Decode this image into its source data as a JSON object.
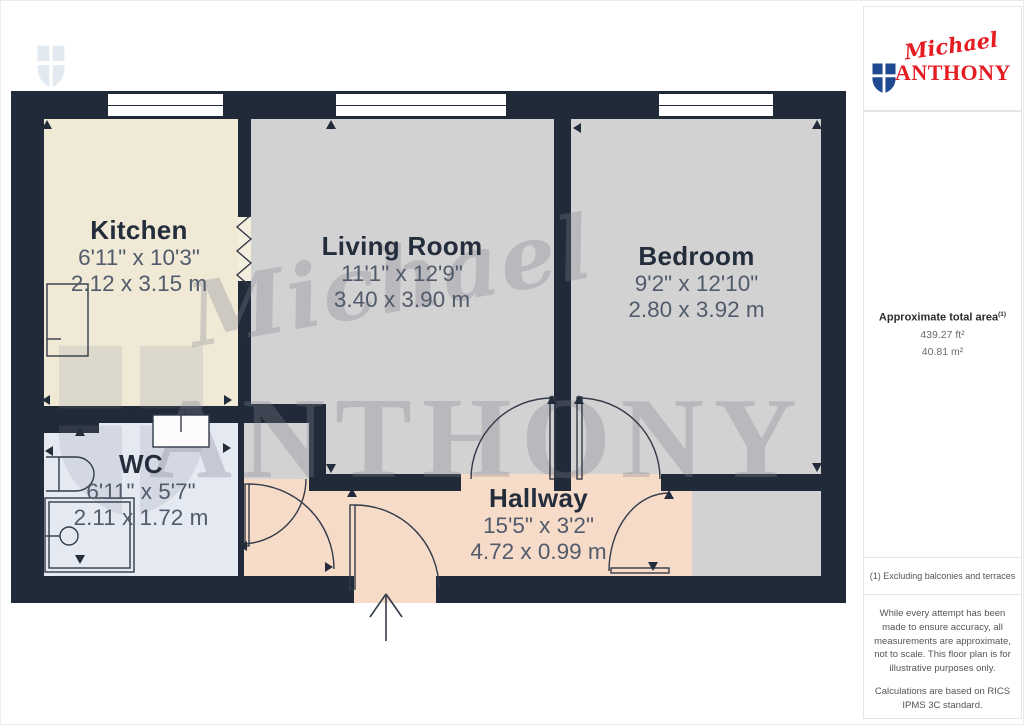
{
  "logo": {
    "script": "Michael",
    "name": "ANTHONY"
  },
  "watermark": {
    "script": "Michael",
    "name": "ANTHONY"
  },
  "rooms": [
    {
      "name": "Kitchen",
      "imperial": "6'11\" x 10'3\"",
      "metric": "2.12 x 3.15 m"
    },
    {
      "name": "Living Room",
      "imperial": "11'1\" x 12'9\"",
      "metric": "3.40 x 3.90 m"
    },
    {
      "name": "Bedroom",
      "imperial": "9'2\" x 12'10\"",
      "metric": "2.80 x 3.92 m"
    },
    {
      "name": "WC",
      "imperial": "6'11\" x 5'7\"",
      "metric": "2.11 x 1.72 m"
    },
    {
      "name": "Hallway",
      "imperial": "15'5\" x 3'2\"",
      "metric": "4.72 x 0.99 m"
    }
  ],
  "sidebar": {
    "area_title": "Approximate total area",
    "area_sup": "(1)",
    "area_ft": "439.27 ft²",
    "area_m": "40.81 m²",
    "footnote": "(1) Excluding balconies and terraces",
    "disclaimer1": "While every attempt has been made to ensure accuracy, all measurements are approximate, not to scale. This floor plan is for illustrative purposes only.",
    "disclaimer2": "Calculations are based on RICS IPMS 3C standard.",
    "brand_word": "GIRAFFE",
    "brand_num": "360"
  },
  "colors": {
    "wall": "#212a38",
    "kitchen": "#efe9d6",
    "living": "#d3d2d2",
    "wc": "#e5e9f2",
    "hallway": "#f7dbc9",
    "logo_red": "#e51d23",
    "logo_blue": "#1e4a8f"
  }
}
